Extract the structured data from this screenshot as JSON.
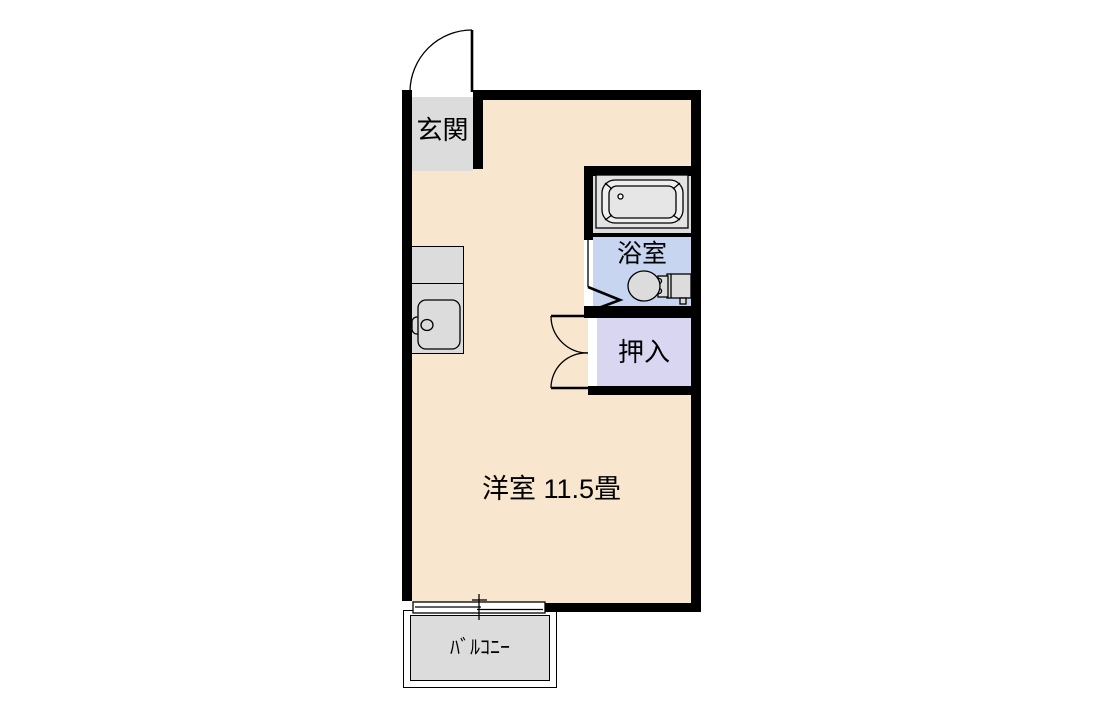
{
  "colors": {
    "wall": "#000000",
    "line": "#000000",
    "background": "#FFFFFF",
    "floor": "#F8E7CE",
    "room_gray": "#DCDCDC",
    "bathroom_blue": "#C8D5F1",
    "closet_lavender": "#D9D6F1",
    "tub_outer": "#E3E3E3",
    "tub_rim": "#EFEFEF",
    "tub_basin": "#E6E6E6"
  },
  "rooms": {
    "genkan": {
      "label": "玄関"
    },
    "bathroom": {
      "label": "浴室"
    },
    "closet": {
      "label": "押入"
    },
    "main_room": {
      "label": "洋室 11.5畳"
    },
    "balcony": {
      "label": "ﾊﾞﾙｺﾆｰ"
    }
  },
  "fixtures": {
    "entry_door": "entry-door-swing",
    "bathtub": "bathtub",
    "toilet": "toilet",
    "kitchen_sink": "kitchen-sink-counter",
    "bathroom_door": "folding-door",
    "closet_doors": "double-swing-doors",
    "balcony_window": "sliding-window"
  }
}
